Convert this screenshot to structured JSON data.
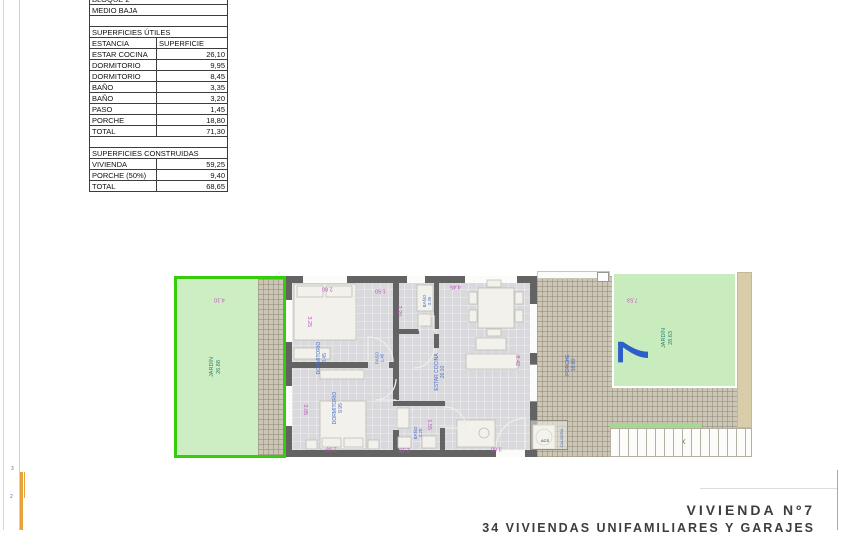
{
  "title_block": {
    "line1": "VIVIENDA Nº7",
    "line2": "34 VIVIENDAS UNIFAMILIARES Y GARAJES"
  },
  "areas_table": {
    "block": "BLOQUE 2",
    "floor": "MEDIO BAJA",
    "utiles_title": "SUPERFICIES ÚTILES",
    "col_estancia": "ESTANCIA",
    "col_superficie": "SUPERFICIE",
    "utiles_rows": [
      [
        "ESTAR COCINA",
        "26,10"
      ],
      [
        "DORMITORIO",
        "9,95"
      ],
      [
        "DORMITORIO",
        "8,45"
      ],
      [
        "BAÑO",
        "3,35"
      ],
      [
        "BAÑO",
        "3,20"
      ],
      [
        "PASO",
        "1,45"
      ],
      [
        "PORCHE",
        "18,80"
      ],
      [
        "TOTAL",
        "71,30"
      ]
    ],
    "construidas_title": "SUPERFICIES CONSTRUIDAS",
    "construidas_rows": [
      [
        "VIVIENDA",
        "59,25"
      ],
      [
        "PORCHE (50%)",
        "9,40"
      ],
      [
        "TOTAL",
        "68,65"
      ]
    ]
  },
  "plan": {
    "unit_number": "7",
    "jardin_left": {
      "name": "JARDÍN",
      "area": "26.88"
    },
    "jardin_right": {
      "name": "JARDÍN",
      "area": "28.63"
    },
    "porche": {
      "name": "PORCHE",
      "area": "18.80"
    },
    "estar": {
      "name": "ESTAR COCINA",
      "area": "26.10"
    },
    "dorm1": {
      "name": "DORMITORIO",
      "area": "8.45"
    },
    "dorm2": {
      "name": "DORMITORIO",
      "area": "9.95"
    },
    "bano1": {
      "name": "BAÑO",
      "area": "3.35"
    },
    "bano2": {
      "name": "BAÑO",
      "area": "3.20"
    },
    "paso": {
      "name": "PASO",
      "area": "1.45"
    },
    "caldera": {
      "name": "CALDERA",
      "acs": "ACS"
    },
    "dims": {
      "jardin_left_w": "4.10",
      "dorm1_w": "2.80",
      "dorm1_h": "3.25",
      "bano1_w": "1.50",
      "bano1_h": "2.20",
      "dorm2_h": "3.05",
      "dorm2_w": "2.93",
      "bano2_w": "1.55",
      "bano2_bottom": "2.18",
      "estar_w": "4.45",
      "estar_h": "8.42",
      "estar_bottom": "3.00",
      "jardin_right_w": "7.53"
    },
    "colors": {
      "garden_fill": "#c9ecbf",
      "garden_border": "#35cc0a",
      "wall": "#636363",
      "dimension_text": "#c24fc2",
      "room_label_text": "#4a6fc4",
      "unit_number_text": "#2e5fc9",
      "beige_strip": "#d9cda9"
    }
  },
  "scale_bar": {
    "tick1": "3",
    "tick2": "2"
  }
}
